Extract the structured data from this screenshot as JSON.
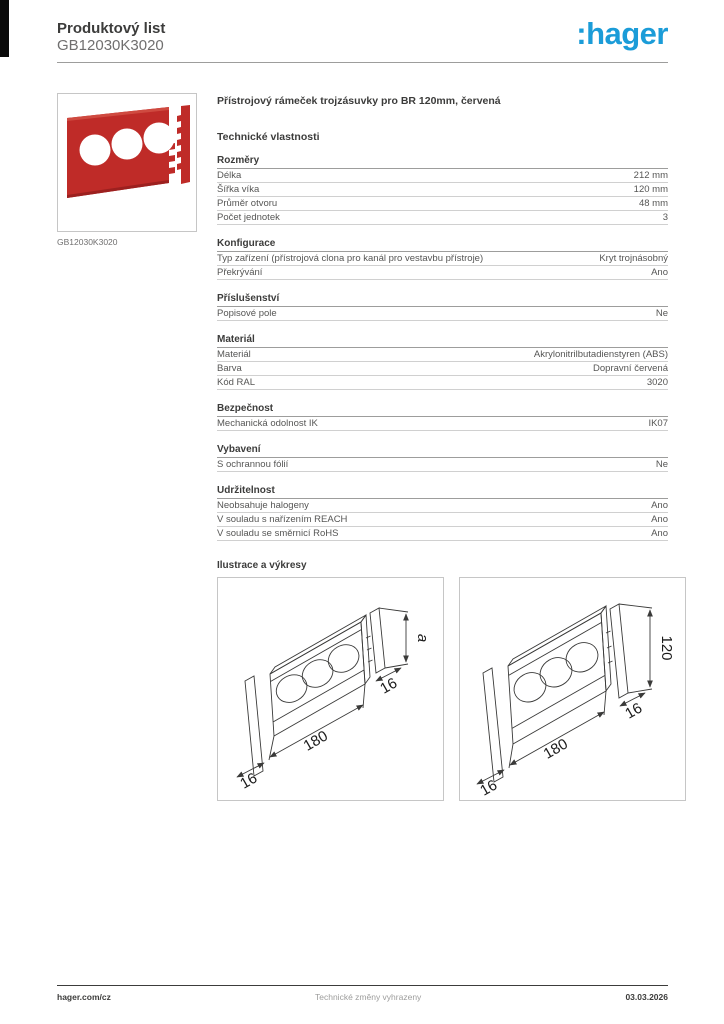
{
  "header": {
    "doc_type": "Produktový list",
    "product_code": "GB12030K3020",
    "logo_text": ":hager",
    "logo_color": "#1b9cd8"
  },
  "product": {
    "image_caption": "GB12030K3020",
    "title": "Přístrojový rámeček trojzásuvky pro BR 120mm, červená",
    "tech_heading": "Technické vlastnosti",
    "photo_red": "#bf2b28"
  },
  "sections": [
    {
      "title": "Rozměry",
      "rows": [
        {
          "label": "Délka",
          "value": "212 mm"
        },
        {
          "label": "Šířka víka",
          "value": "120 mm"
        },
        {
          "label": "Průměr otvoru",
          "value": "48 mm"
        },
        {
          "label": "Počet jednotek",
          "value": "3"
        }
      ]
    },
    {
      "title": "Konfigurace",
      "rows": [
        {
          "label": "Typ zařízení (přístrojová clona pro kanál pro vestavbu přístroje)",
          "value": "Kryt trojnásobný"
        },
        {
          "label": "Překrývání",
          "value": "Ano"
        }
      ]
    },
    {
      "title": "Příslušenství",
      "rows": [
        {
          "label": "Popisové pole",
          "value": "Ne"
        }
      ]
    },
    {
      "title": "Materiál",
      "rows": [
        {
          "label": "Materiál",
          "value": "Akrylonitrilbutadienstyren (ABS)"
        },
        {
          "label": "Barva",
          "value": "Dopravní červená"
        },
        {
          "label": "Kód RAL",
          "value": "3020"
        }
      ]
    },
    {
      "title": "Bezpečnost",
      "rows": [
        {
          "label": "Mechanická odolnost IK",
          "value": "IK07"
        }
      ]
    },
    {
      "title": "Vybavení",
      "rows": [
        {
          "label": "S ochrannou fólií",
          "value": "Ne"
        }
      ]
    },
    {
      "title": "Udržitelnost",
      "rows": [
        {
          "label": "Neobsahuje halogeny",
          "value": "Ano"
        },
        {
          "label": "V souladu s nařízením REACH",
          "value": "Ano"
        },
        {
          "label": "V souladu se směrnicí RoHS",
          "value": "Ano"
        }
      ]
    }
  ],
  "illustrations": {
    "heading": "Ilustrace a výkresy",
    "drawings": [
      {
        "length_label": "180",
        "side_label": "16",
        "end_label": "16",
        "height_label": "a"
      },
      {
        "length_label": "180",
        "side_label": "16",
        "end_label": "16",
        "height_label": "120"
      }
    ]
  },
  "footer": {
    "left": "hager.com/cz",
    "center": "Technické změny vyhrazeny",
    "right": "03.03.2026"
  }
}
